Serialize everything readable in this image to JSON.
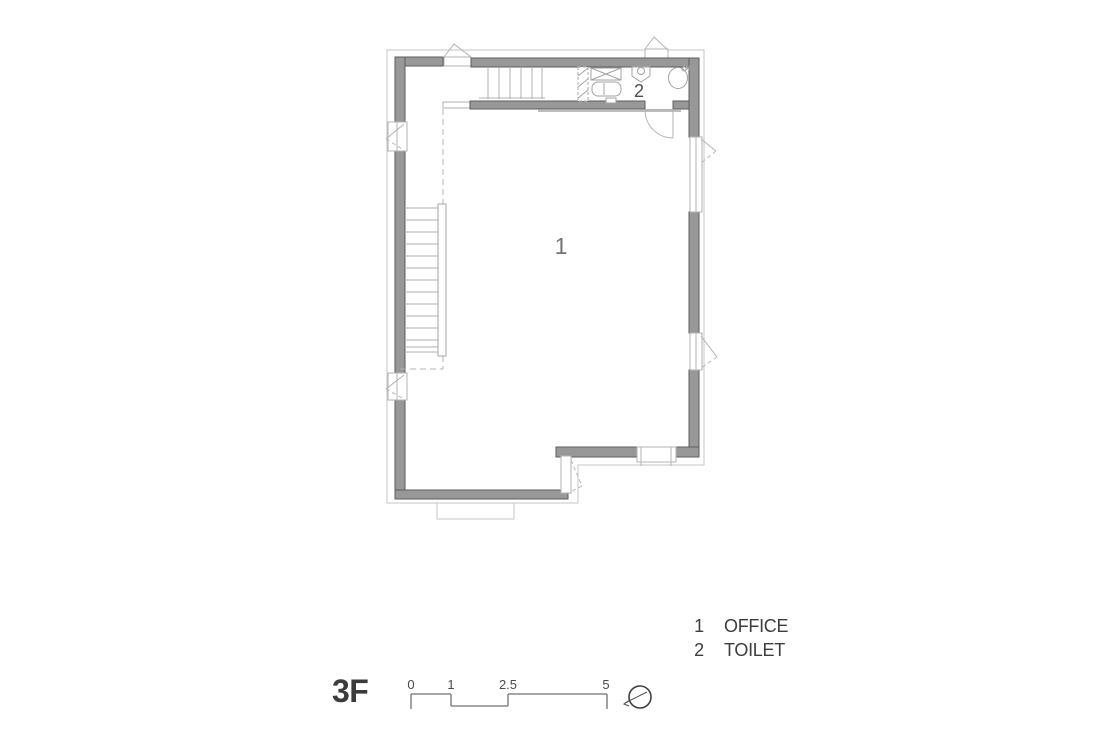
{
  "drawing": {
    "type": "architectural-floor-plan",
    "floor_label": "3F",
    "room_labels": {
      "office": "1",
      "toilet": "2"
    },
    "legend": {
      "items": [
        {
          "number": "1",
          "name": "OFFICE"
        },
        {
          "number": "2",
          "name": "TOILET"
        }
      ]
    },
    "scale_bar": {
      "labels": [
        "0",
        "1",
        "2.5",
        "5"
      ]
    },
    "icons": [
      "north-arrow-icon"
    ],
    "colors": {
      "background": "#ffffff",
      "wall_fill": "#989898",
      "wall_edge": "#5e5e5e",
      "thin_line": "#b3b3b3",
      "eave_line": "#c6c6c6",
      "dashed_line": "#b5b5b5",
      "scalebar_line": "#707070",
      "text_dark": "#3b3b3b",
      "text_gray": "#757575"
    }
  }
}
